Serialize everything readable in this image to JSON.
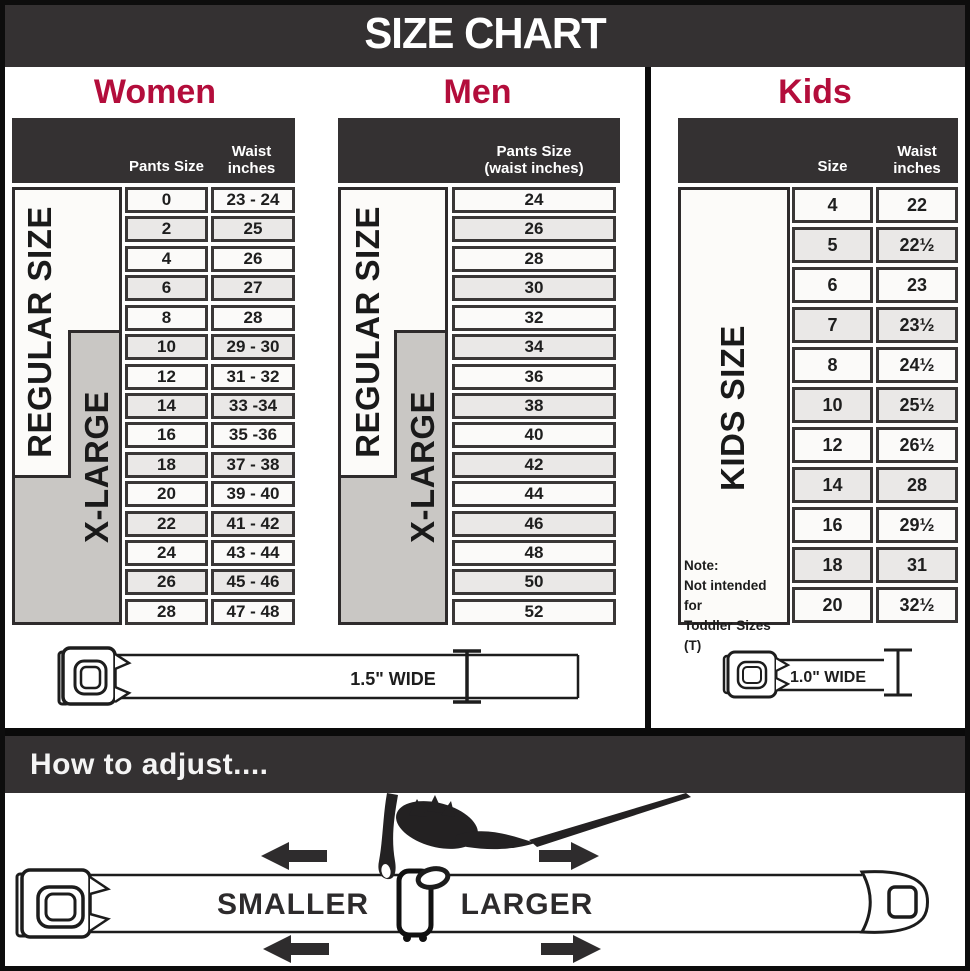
{
  "title": "SIZE CHART",
  "colors": {
    "accent_red": "#b30d3b",
    "dark_band": "#343132",
    "cell_gray": "#eae8e7",
    "label_gray": "#c9c7c4"
  },
  "women": {
    "heading": "Women",
    "pants_header": "Pants Size",
    "waist_header_line1": "Waist",
    "waist_header_line2": "inches",
    "regular_label": "REGULAR SIZE",
    "xlarge_label": "X-LARGE",
    "rows": [
      {
        "size": "0",
        "waist": "23 - 24"
      },
      {
        "size": "2",
        "waist": "25"
      },
      {
        "size": "4",
        "waist": "26"
      },
      {
        "size": "6",
        "waist": "27"
      },
      {
        "size": "8",
        "waist": "28"
      },
      {
        "size": "10",
        "waist": "29 - 30"
      },
      {
        "size": "12",
        "waist": "31 - 32"
      },
      {
        "size": "14",
        "waist": "33 -34"
      },
      {
        "size": "16",
        "waist": "35 -36"
      },
      {
        "size": "18",
        "waist": "37 - 38"
      },
      {
        "size": "20",
        "waist": "39 - 40"
      },
      {
        "size": "22",
        "waist": "41 - 42"
      },
      {
        "size": "24",
        "waist": "43 - 44"
      },
      {
        "size": "26",
        "waist": "45 - 46"
      },
      {
        "size": "28",
        "waist": "47 - 48"
      }
    ]
  },
  "men": {
    "heading": "Men",
    "header_line1": "Pants Size",
    "header_line2": "(waist inches)",
    "regular_label": "REGULAR SIZE",
    "xlarge_label": "X-LARGE",
    "sizes": [
      "24",
      "26",
      "28",
      "30",
      "32",
      "34",
      "36",
      "38",
      "40",
      "42",
      "44",
      "46",
      "48",
      "50",
      "52"
    ]
  },
  "kids": {
    "heading": "Kids",
    "size_header": "Size",
    "waist_header_line1": "Waist",
    "waist_header_line2": "inches",
    "side_label": "KIDS SIZE",
    "note_line1": "Note:",
    "note_line2": "Not intended for",
    "note_line3": "Toddler Sizes (T)",
    "rows": [
      {
        "size": "4",
        "waist": "22"
      },
      {
        "size": "5",
        "waist": "22½"
      },
      {
        "size": "6",
        "waist": "23"
      },
      {
        "size": "7",
        "waist": "23½"
      },
      {
        "size": "8",
        "waist": "24½"
      },
      {
        "size": "10",
        "waist": "25½"
      },
      {
        "size": "12",
        "waist": "26½"
      },
      {
        "size": "14",
        "waist": "28"
      },
      {
        "size": "16",
        "waist": "29½"
      },
      {
        "size": "18",
        "waist": "31"
      },
      {
        "size": "20",
        "waist": "32½"
      }
    ]
  },
  "belts": {
    "adult_width_label": "1.5\" WIDE",
    "kids_width_label": "1.0\" WIDE"
  },
  "adjust": {
    "heading": "How to adjust....",
    "smaller_label": "SMALLER",
    "larger_label": "LARGER"
  }
}
